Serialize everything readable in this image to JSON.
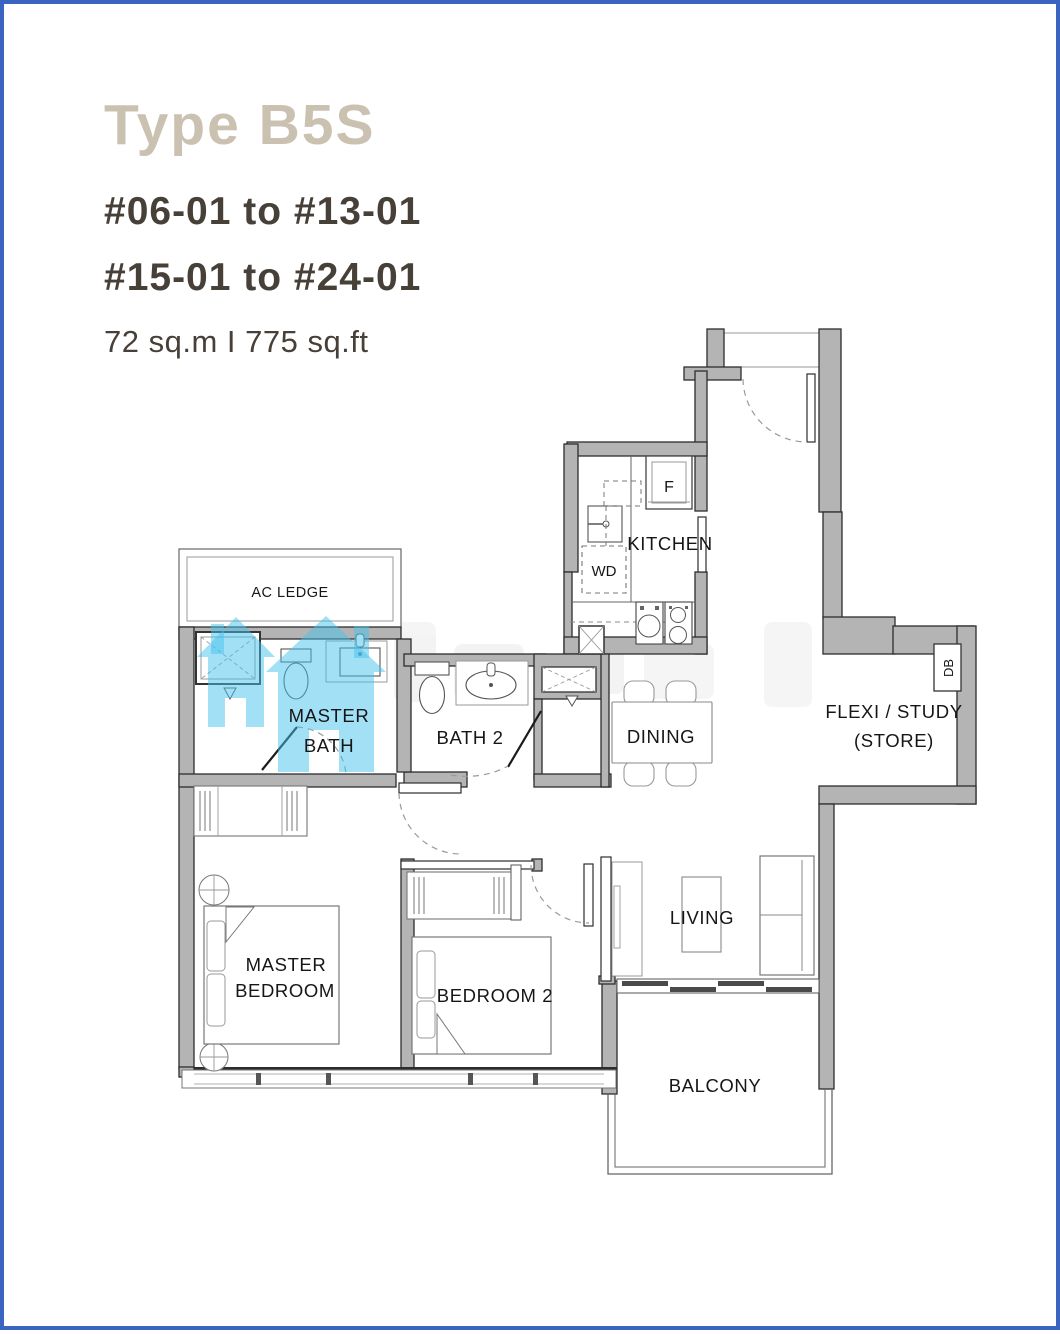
{
  "page": {
    "border_color": "#3a64bf"
  },
  "header": {
    "title": "Type B5S",
    "units_line1": "#06-01 to #13-01",
    "units_line2": "#15-01 to #24-01",
    "area": "72 sq.m I 775 sq.ft"
  },
  "floorplan": {
    "rooms": {
      "ac_ledge": "AC LEDGE",
      "master_bath_line1": "MASTER",
      "master_bath_line2": "BATH",
      "bath_2": "BATH 2",
      "kitchen": "KITCHEN",
      "dining": "DINING",
      "flexi_line1": "FLEXI / STUDY",
      "flexi_line2": "(STORE)",
      "living": "LIVING",
      "master_bedroom_line1": "MASTER",
      "master_bedroom_line2": "BEDROOM",
      "bedroom_2": "BEDROOM 2",
      "balcony": "BALCONY"
    },
    "fixtures": {
      "fridge": "F",
      "washer_dryer": "WD",
      "distribution_board": "DB"
    },
    "colors": {
      "wall_fill": "#b4b4b4",
      "watermark_blue": "#45c1ee"
    }
  }
}
